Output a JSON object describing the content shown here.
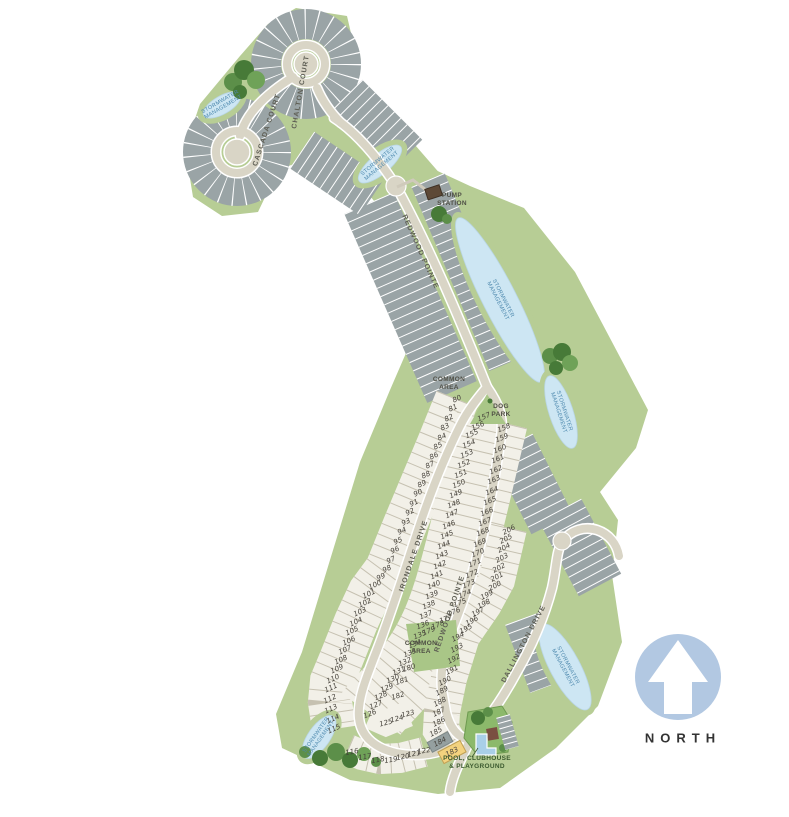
{
  "map_type": "residential-community-site-plan",
  "north": {
    "label": "NORTH"
  },
  "street_labels": [
    {
      "text": "CHALTON COURT",
      "x": 301,
      "y": 92,
      "rot": -80
    },
    {
      "text": "CASCADA COURT",
      "x": 267,
      "y": 130,
      "rot": -72
    },
    {
      "text": "REDWOOD POINTE",
      "x": 420,
      "y": 252,
      "rot": 66
    },
    {
      "text": "IRONDALE DRIVE",
      "x": 414,
      "y": 556,
      "rot": -71
    },
    {
      "text": "REDWOOD POINTE",
      "x": 450,
      "y": 614,
      "rot": -71
    },
    {
      "text": "DALLINGTON DRIVE",
      "x": 524,
      "y": 644,
      "rot": -62
    }
  ],
  "area_labels": [
    {
      "text": "COMMON\nAREA",
      "x": 449,
      "y": 384,
      "cls": ""
    },
    {
      "text": "DOG\nPARK",
      "x": 501,
      "y": 411,
      "cls": ""
    },
    {
      "text": "COMMON\nAREA",
      "x": 421,
      "y": 648,
      "cls": ""
    },
    {
      "text": "PUMP\nSTATION",
      "x": 452,
      "y": 200,
      "cls": ""
    },
    {
      "text": "POOL, CLUBHOUSE\n& PLAYGROUND",
      "x": 477,
      "y": 763,
      "cls": "pool"
    }
  ],
  "pond_label": "STORMWATER\nMANAGEMENT",
  "ponds": [
    {
      "x": 222,
      "y": 105,
      "rot": -30,
      "rx": 21,
      "ry": 9
    },
    {
      "x": 380,
      "y": 164,
      "rot": -40,
      "rx": 27,
      "ry": 10
    },
    {
      "x": 500,
      "y": 300,
      "rot": 63,
      "rx": 92,
      "ry": 17
    },
    {
      "x": 561,
      "y": 412,
      "rot": 72,
      "rx": 38,
      "ry": 12
    },
    {
      "x": 565,
      "y": 667,
      "rot": 62,
      "rx": 48,
      "ry": 15
    },
    {
      "x": 319,
      "y": 737,
      "rot": -55,
      "rx": 25,
      "ry": 11
    }
  ],
  "lots": {
    "columns": [
      {
        "id": "west-outer",
        "tilt": -25,
        "numbers": [
          80,
          81,
          82,
          83,
          84,
          85,
          86,
          87,
          88,
          89,
          90,
          91,
          92,
          93,
          94,
          95,
          96,
          97,
          98,
          99,
          100,
          101,
          102,
          103,
          104,
          105,
          106,
          107,
          108,
          109,
          110,
          111,
          112,
          113,
          114,
          115
        ],
        "points": [
          [
            457,
            399
          ],
          [
            440,
            441
          ],
          [
            422,
            484
          ],
          [
            404,
            527
          ],
          [
            387,
            569
          ],
          [
            370,
            592
          ],
          [
            356,
            622
          ],
          [
            342,
            657
          ],
          [
            332,
            681
          ],
          [
            330,
            702
          ],
          [
            334,
            729
          ]
        ]
      },
      {
        "id": "bottom-row",
        "tilt": -10,
        "numbers": [
          116,
          117,
          118,
          119,
          120,
          121,
          122
        ],
        "points": [
          [
            352,
            752
          ],
          [
            365,
            757
          ],
          [
            378,
            760
          ],
          [
            391,
            760
          ],
          [
            403,
            757
          ],
          [
            414,
            754
          ],
          [
            424,
            751
          ]
        ]
      },
      {
        "id": "island-tip",
        "tilt": -15,
        "numbers": [
          125,
          124,
          123
        ],
        "points": [
          [
            386,
            723
          ],
          [
            397,
            719
          ],
          [
            408,
            714
          ]
        ]
      },
      {
        "id": "island-west",
        "tilt": -22,
        "numbers": [
          157,
          156,
          155,
          154,
          153,
          152,
          151,
          150,
          149,
          148,
          147,
          146,
          145,
          144,
          143,
          142,
          141,
          140,
          139,
          138,
          137,
          136,
          135,
          134,
          133,
          132,
          131,
          130,
          129,
          128,
          127,
          126
        ],
        "points": [
          [
            484,
            417
          ],
          [
            471,
            436
          ],
          [
            463,
            468
          ],
          [
            455,
            500
          ],
          [
            447,
            534
          ],
          [
            439,
            568
          ],
          [
            430,
            602
          ],
          [
            420,
            634
          ],
          [
            404,
            664
          ],
          [
            384,
            692
          ],
          [
            370,
            714
          ]
        ]
      },
      {
        "id": "island-east",
        "tilt": -22,
        "numbers": [
          158,
          159,
          160,
          161,
          162,
          163,
          164,
          165,
          166,
          167,
          168,
          169,
          170,
          171,
          172,
          173,
          174,
          175,
          176,
          177,
          178,
          179
        ],
        "points": [
          [
            504,
            428
          ],
          [
            497,
            464
          ],
          [
            489,
            505
          ],
          [
            479,
            548
          ],
          [
            469,
            585
          ],
          [
            458,
            608
          ],
          [
            443,
            622
          ],
          [
            429,
            631
          ]
        ]
      },
      {
        "id": "island-east-end",
        "tilt": -18,
        "numbers": [
          180,
          181,
          182
        ],
        "points": [
          [
            409,
            668
          ],
          [
            402,
            681
          ],
          [
            398,
            696
          ]
        ]
      },
      {
        "id": "east-col",
        "tilt": -28,
        "numbers": [
          206,
          205,
          204,
          203,
          202,
          201,
          200,
          199,
          198,
          197,
          196,
          195,
          194,
          193,
          192,
          191,
          190,
          189,
          188,
          187,
          186,
          185,
          184,
          183
        ],
        "points": [
          [
            509,
            530
          ],
          [
            506,
            539
          ],
          [
            504,
            548
          ],
          [
            502,
            558
          ],
          [
            499,
            568
          ],
          [
            497,
            577
          ],
          [
            495,
            586
          ],
          [
            487,
            595
          ],
          [
            484,
            604
          ],
          [
            478,
            612
          ],
          [
            472,
            621
          ],
          [
            466,
            629
          ],
          [
            458,
            637
          ],
          [
            457,
            648
          ],
          [
            454,
            659
          ],
          [
            452,
            670
          ],
          [
            445,
            681
          ],
          [
            442,
            691
          ],
          [
            440,
            702
          ],
          [
            439,
            712
          ],
          [
            439,
            722
          ],
          [
            436,
            732
          ],
          [
            440,
            742
          ],
          [
            452,
            752
          ]
        ]
      }
    ],
    "highlights": {
      "183": {
        "w": 24,
        "h": 12,
        "color": "#f3d27e",
        "border": "#bfa055"
      },
      "184": {
        "w": 22,
        "h": 10,
        "color": "#95a0a0",
        "border": "#7d8888"
      }
    }
  },
  "colors": {
    "land": "#b7cd95",
    "road": "#d9d5c6",
    "road_casing": "#ffffff",
    "unnumbered_lot_gray": "#9aa4a6",
    "numbered_lot_light": "#f2f0e8",
    "pond_blue": "#cde6f3",
    "pond_label_blue": "#4e89ae",
    "tree_green_dark": "#477a38",
    "tree_green_mid": "#5c8f49",
    "tree_green_light": "#6fa258",
    "lot_183_highlight": "#f3d27e",
    "lot_184_fill": "#95a0a0",
    "north_circle_blue": "#b2c8e2",
    "north_text": "#333333",
    "pump_station_brown": "#5d4936",
    "pool_water": "#a9cfe8",
    "clubhouse_roof": "#7a4f41",
    "amenity_green": "#a9c687",
    "label_text": "#4f4f45",
    "street_text": "#5e5e54",
    "lot_number_text": "#45413a"
  }
}
